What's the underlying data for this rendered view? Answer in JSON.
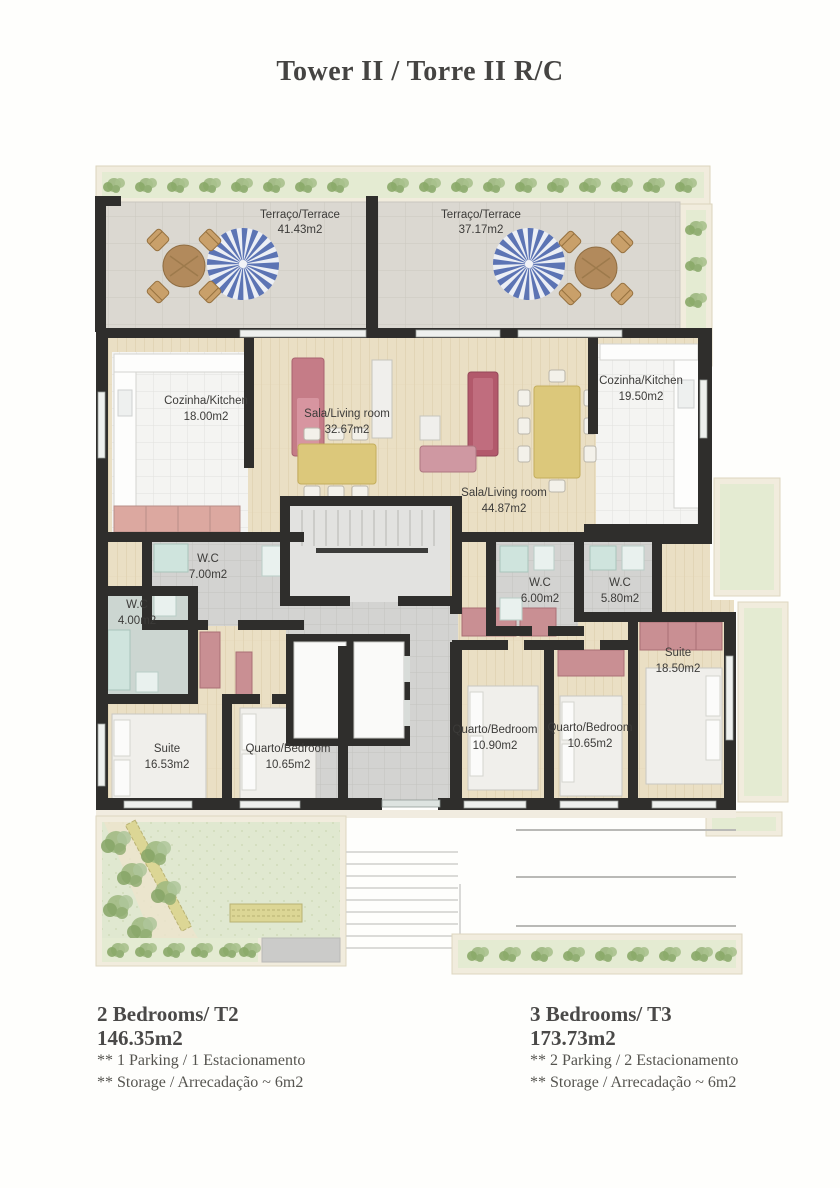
{
  "title": "Tower II / Torre II  R/C",
  "rooms": {
    "terrace_left": {
      "label": "Terraço/Terrace",
      "area": "41.43m2"
    },
    "terrace_right": {
      "label": "Terraço/Terrace",
      "area": "37.17m2"
    },
    "kitchen_t2": {
      "label": "Cozinha/Kitchen",
      "area": "18.00m2"
    },
    "living_t2": {
      "label": "Sala/Living room",
      "area": "32.67m2"
    },
    "wc1_t2": {
      "label": "W.C",
      "area": "7.00m2"
    },
    "wc2_t2": {
      "label": "W.C",
      "area": "4.00m2"
    },
    "suite_t2": {
      "label": "Suite",
      "area": "16.53m2"
    },
    "bedroom_t2": {
      "label": "Quarto/Bedroom",
      "area": "10.65m2"
    },
    "kitchen_t3": {
      "label": "Cozinha/Kitchen",
      "area": "19.50m2"
    },
    "living_t3": {
      "label": "Sala/Living room",
      "area": "44.87m2"
    },
    "wc1_t3": {
      "label": "W.C",
      "area": "6.00m2"
    },
    "wc2_t3": {
      "label": "W.C",
      "area": "5.80m2"
    },
    "suite_t3": {
      "label": "Suite",
      "area": "18.50m2"
    },
    "bedroom1_t3": {
      "label": "Quarto/Bedroom",
      "area": "10.90m2"
    },
    "bedroom2_t3": {
      "label": "Quarto/Bedroom",
      "area": "10.65m2"
    }
  },
  "legend": {
    "t2": {
      "name": "2 Bedrooms/ T2",
      "area": "146.35m2",
      "note1": "** 1 Parking / 1 Estacionamento",
      "note2": "** Storage /  Arrecadação ~ 6m2"
    },
    "t3": {
      "name": "3 Bedrooms/ T3",
      "area": "173.73m2",
      "note1": "** 2 Parking / 2 Estacionamento",
      "note2": "** Storage /  Arrecadação ~ 6m2"
    }
  },
  "colors": {
    "wall": "#2f2e2c",
    "wood_floor": "#eadfc4",
    "white_tile": "#f4f4f2",
    "gray_tile": "#d2d2d0",
    "terrace_stone": "#dbd8d1",
    "lawn": "#e0e8d0",
    "planter_frame": "#f1ecdd",
    "shrub_green": "#9cb77f",
    "sofa_pink": "#c57c87",
    "accent_red": "#b2596b",
    "wardrobe_salmon": "#c98f93",
    "table_yellow": "#dcc87b",
    "parasol_blue": "#5c74b4",
    "text_dark": "#3c3b39"
  }
}
